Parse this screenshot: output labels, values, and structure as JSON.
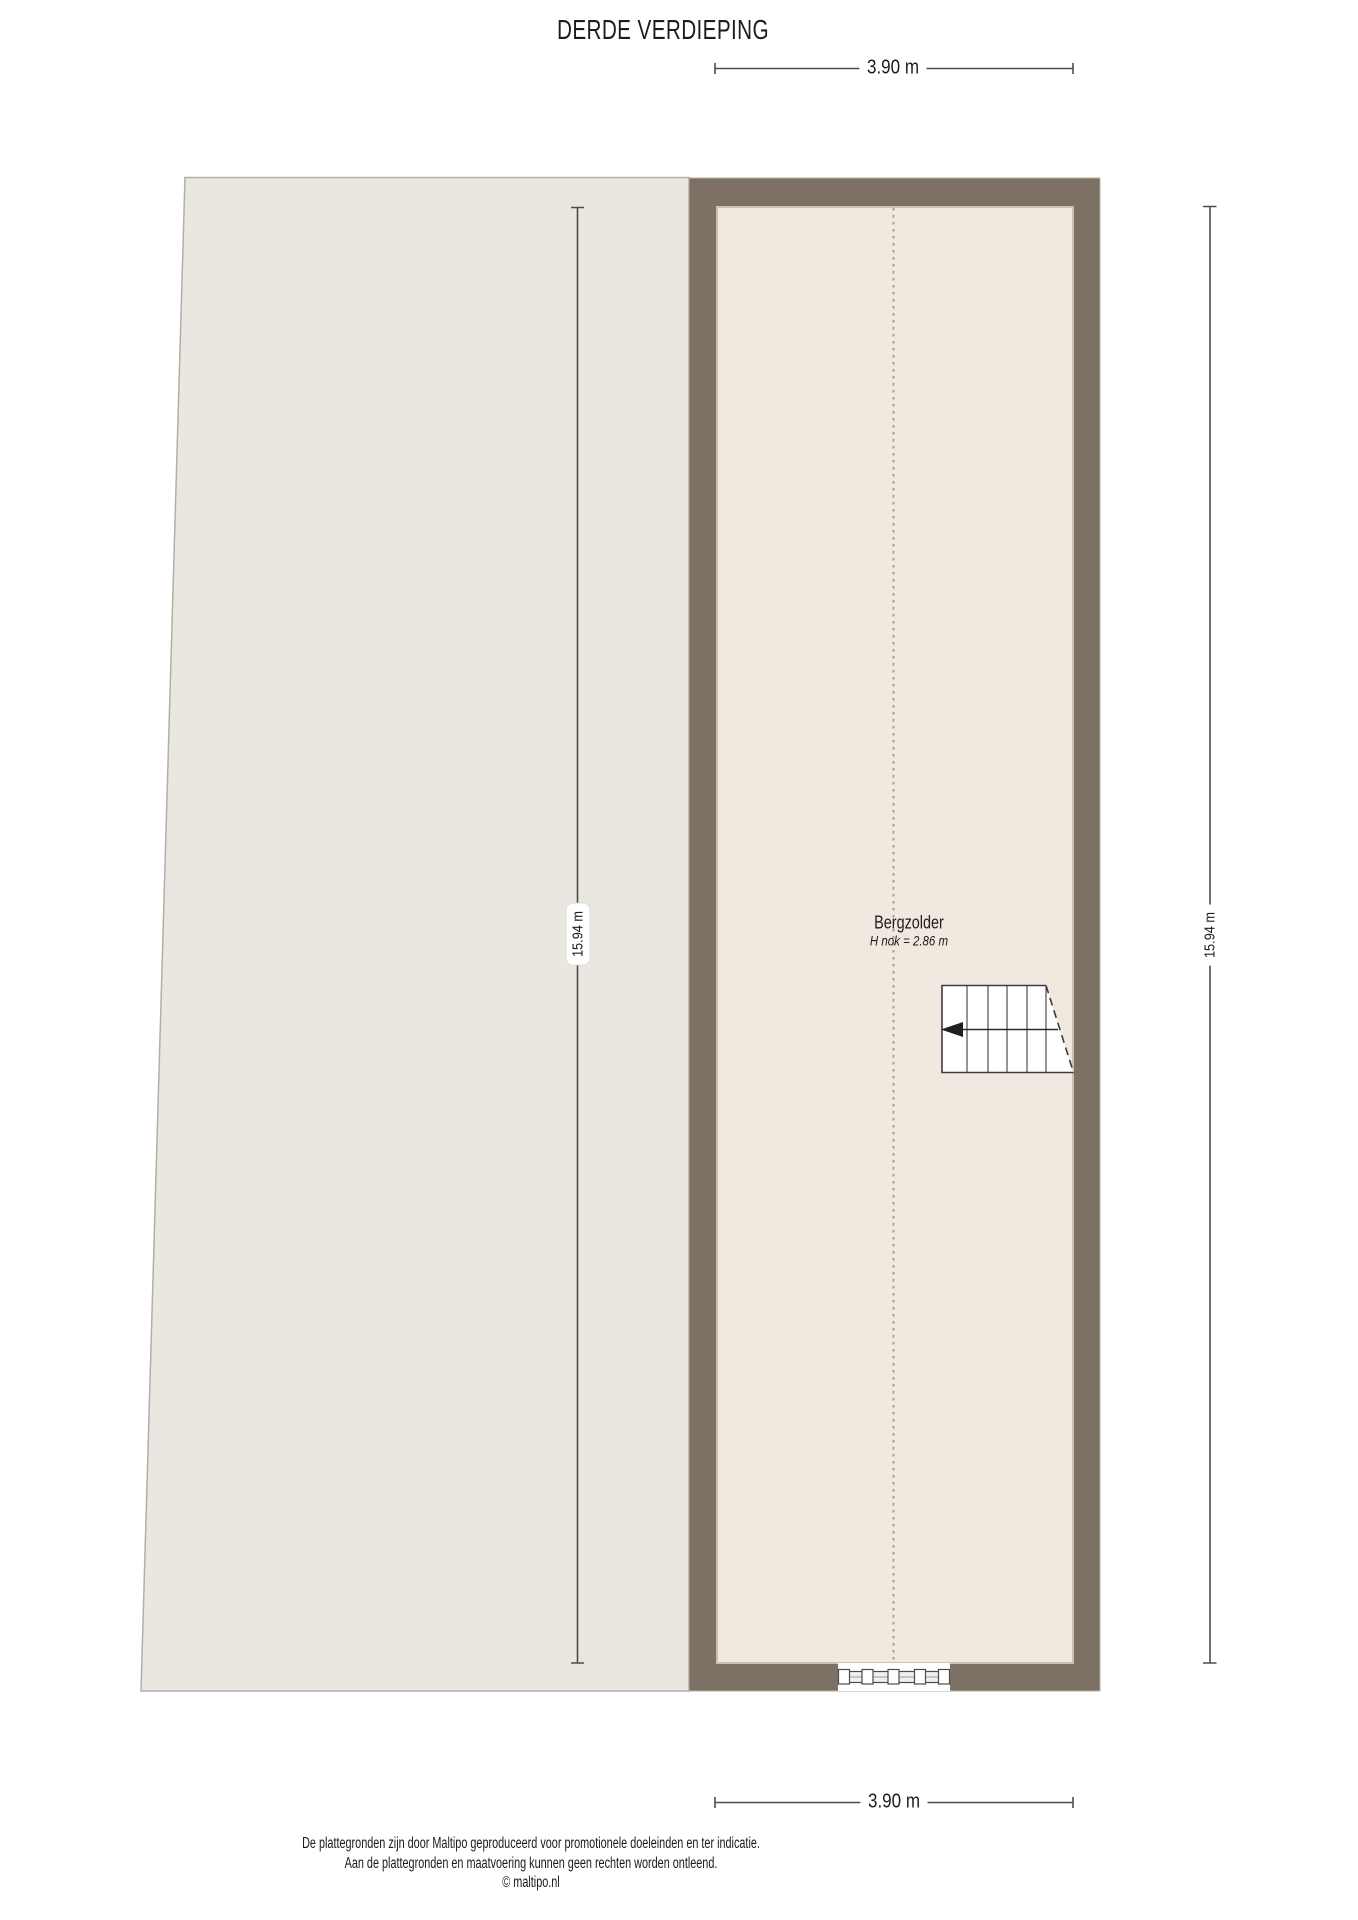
{
  "title": "DERDE VERDIEPING",
  "floor_plan": {
    "room": {
      "name": "Bergzolder",
      "ridge_height_note": "H nok = 2.86 m"
    },
    "dimensions": {
      "width_top": "3.90 m",
      "width_bottom": "3.90 m",
      "depth_left": "15.94 m",
      "depth_right": "15.94 m"
    },
    "colors": {
      "left_area_fill": "#e9e7e0",
      "left_area_border": "#b3afa6",
      "wall": "#7d7166",
      "room_fill": "#f1e9df",
      "room_inner_edge": "#cdc2b2",
      "ridge_line": "#a59f95",
      "dimension_line": "#4d4d4d",
      "stair_line": "#3c3c3c"
    }
  },
  "footer": {
    "disclaimer_line1": "De plattegronden zijn door Maltipo geproduceerd voor promotionele doeleinden en ter indicatie.",
    "disclaimer_line2": "Aan de plattegronden en maatvoering kunnen geen rechten worden ontleend.",
    "copyright": "© maltipo.nl"
  }
}
